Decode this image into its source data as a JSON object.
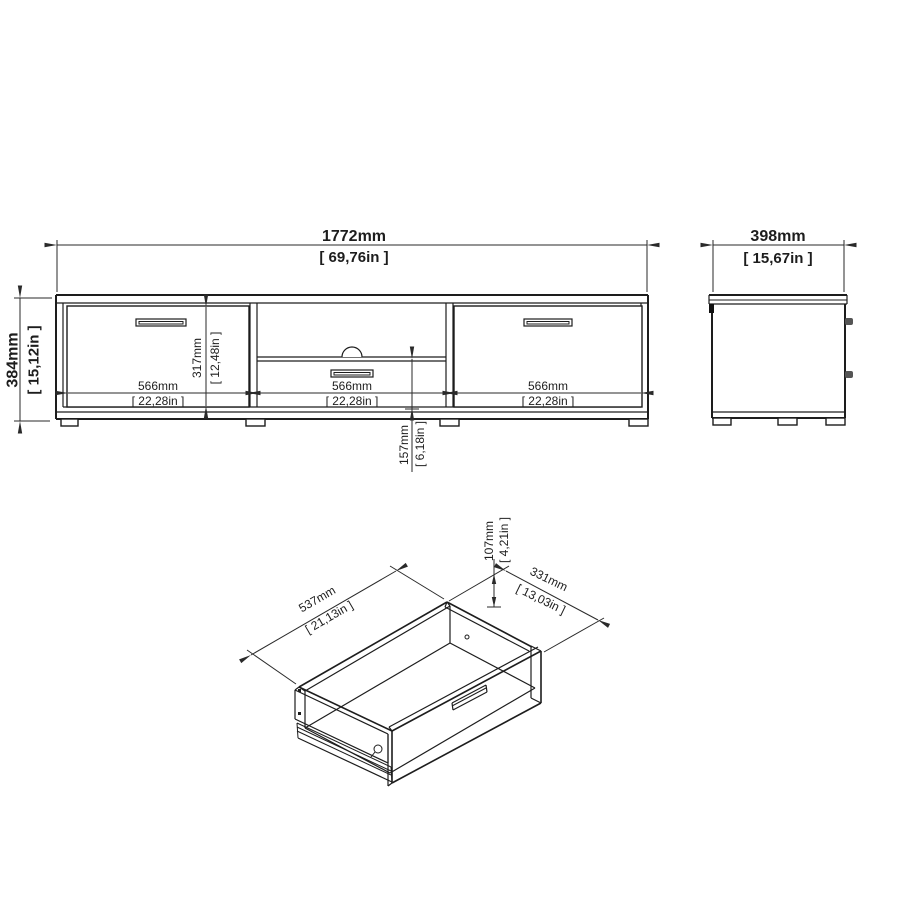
{
  "drawing": {
    "kind": "furniture dimensional drawing",
    "background": "#ffffff",
    "line_color": "#1d1d1d"
  },
  "front": {
    "width_mm": "1772mm",
    "width_in": "[ 69,76in ]",
    "height_mm": "384mm",
    "height_in": "[ 15,12in ]",
    "section_left_mm": "566mm",
    "section_left_in": "[ 22,28in ]",
    "section_mid_mm": "566mm",
    "section_mid_in": "[ 22,28in ]",
    "section_right_mm": "566mm",
    "section_right_in": "[ 22,28in ]",
    "door_height_mm": "317mm",
    "door_height_in": "[ 12,48in ]",
    "drawer_front_mm": "157mm",
    "drawer_front_in": "[ 6,18in ]"
  },
  "side": {
    "depth_mm": "398mm",
    "depth_in": "[ 15,67in ]"
  },
  "drawer": {
    "width_mm": "537mm",
    "width_in": "[ 21,13in ]",
    "depth_mm": "331mm",
    "depth_in": "[ 13,03in ]",
    "height_mm": "107mm",
    "height_in": "[ 4,21in ]"
  }
}
